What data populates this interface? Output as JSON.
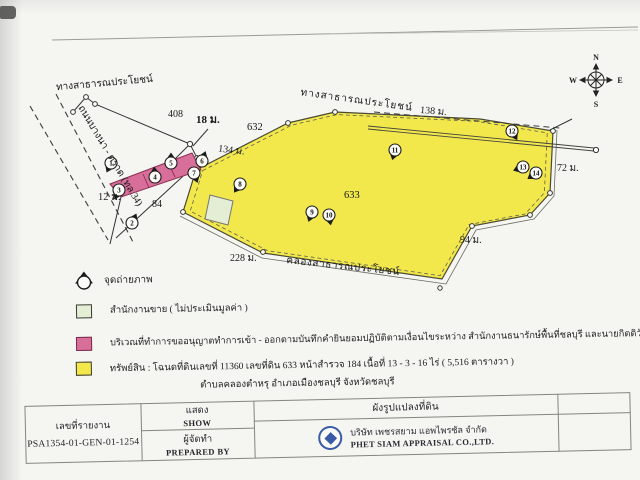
{
  "document": {
    "compass": {
      "north": "N",
      "east": "E",
      "south": "S",
      "west": "W"
    },
    "map": {
      "labels": {
        "public_road_top": "ทางสาธารณประโยชน์",
        "public_road_parcel": "ทางสาธารณประโยชน์",
        "highway": "ถนนบางนา - ตราด (ทล.34)",
        "canal": "คลองสาธารณประโยชน์",
        "dim_road": "408",
        "dim_entrance_width": "18 ม.",
        "adjacent_parcel_no": "632",
        "dim_nw_edge": "134 ม.",
        "dim_n_edge": "138 ม.",
        "dim_e_edge": "72 ม.",
        "dim_se_edge": "94 ม.",
        "dim_s_edge": "228 ม.",
        "dim_entrance": "12 ม.",
        "dim_side": "84",
        "parcel_no": "633"
      },
      "photo_points": [
        "1",
        "2",
        "3",
        "4",
        "5",
        "6",
        "7",
        "8",
        "9",
        "10",
        "11",
        "12",
        "13",
        "14"
      ]
    },
    "legend": {
      "photo_point_label": "จุดถ่ายภาพ",
      "office_label": "สำนักงานขาย ( ไม่ประเมินมูลค่า )",
      "access_label": "บริเวณที่ทำการขออนุญาตทำการเข้า - ออกตามบันทึกคำยินยอมปฏิบัติตามเงื่อนไขระหว่าง สำนักงานธนารักษ์พื้นที่ชลบุรี และนายกิตติวัชร์ (เจ้าของกรรมสิทธิ์ทรัพย์สิน)",
      "property_label": "ทรัพย์สิน : โฉนดที่ดินเลขที่ 11360 เลขที่ดิน 633 หน้าสำรวจ 184 เนื้อที่ 13 - 3 - 16 ไร่ ( 5,516 ตารางวา )",
      "property_label_line2": "ตำบลคลองตำหรุ อำเภอเมืองชลบุรี จังหวัดชลบุรี"
    },
    "title_block": {
      "report_no_label": "เลขที่รายงาน",
      "report_no": "PSA1354-01-GEN-01-1254",
      "show_th": "แสดง",
      "show_en": "SHOW",
      "prepared_th": "ผู้จัดทำ",
      "prepared_en": "PREPARED BY",
      "drawing_title": "ผังรูปแปลงที่ดิน",
      "company_th": "บริษัท เพชรสยาม แอพไพรซัล จำกัด",
      "company_en": "PHET SIAM APPRAISAL CO.,LTD."
    },
    "colors": {
      "parcel_fill": "#f2e84c",
      "access_fill": "#d86f9b",
      "office_fill": "#e3eed4",
      "logo_blue": "#3a5ba6"
    }
  }
}
